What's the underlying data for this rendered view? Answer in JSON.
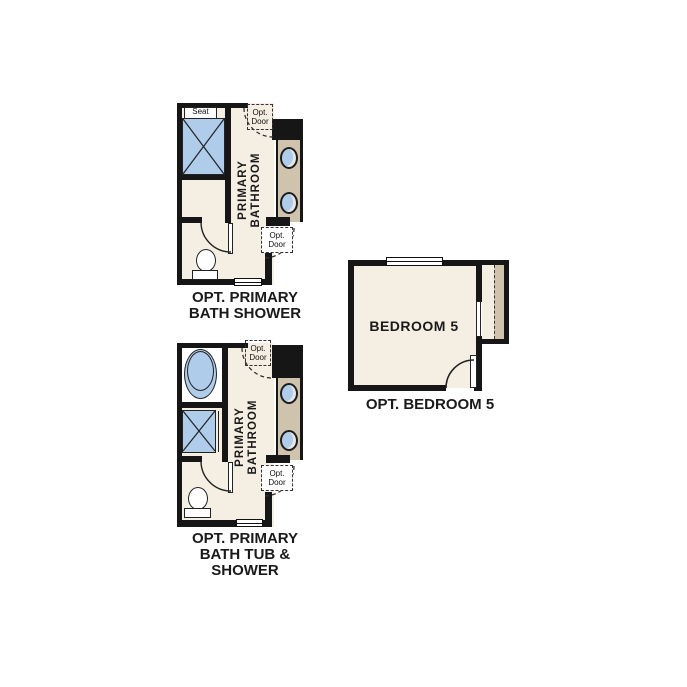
{
  "title": "floor-plan-options",
  "colors": {
    "wall": "#161616",
    "floor": "#f5efe3",
    "counter_tan": "#cfc3ae",
    "fixture_blue": "#afccea",
    "text": "#1a1a1a"
  },
  "bath_shower": {
    "caption_line1": "OPT. PRIMARY",
    "caption_line2": "BATH SHOWER",
    "room_line1": "PRIMARY",
    "room_line2": "BATHROOM",
    "seat": "Seat",
    "opt_door_top_line1": "Opt.",
    "opt_door_top_line2": "Door",
    "opt_door_bottom_line1": "Opt.",
    "opt_door_bottom_line2": "Door"
  },
  "bath_tub_shower": {
    "caption_line1": "OPT. PRIMARY",
    "caption_line2": "BATH TUB &",
    "caption_line3": "SHOWER",
    "room_line1": "PRIMARY",
    "room_line2": "BATHROOM",
    "opt_door_top_line1": "Opt.",
    "opt_door_top_line2": "Door",
    "opt_door_bottom_line1": "Opt.",
    "opt_door_bottom_line2": "Door"
  },
  "bedroom5": {
    "room_label": "BEDROOM 5",
    "caption": "OPT. BEDROOM 5"
  }
}
